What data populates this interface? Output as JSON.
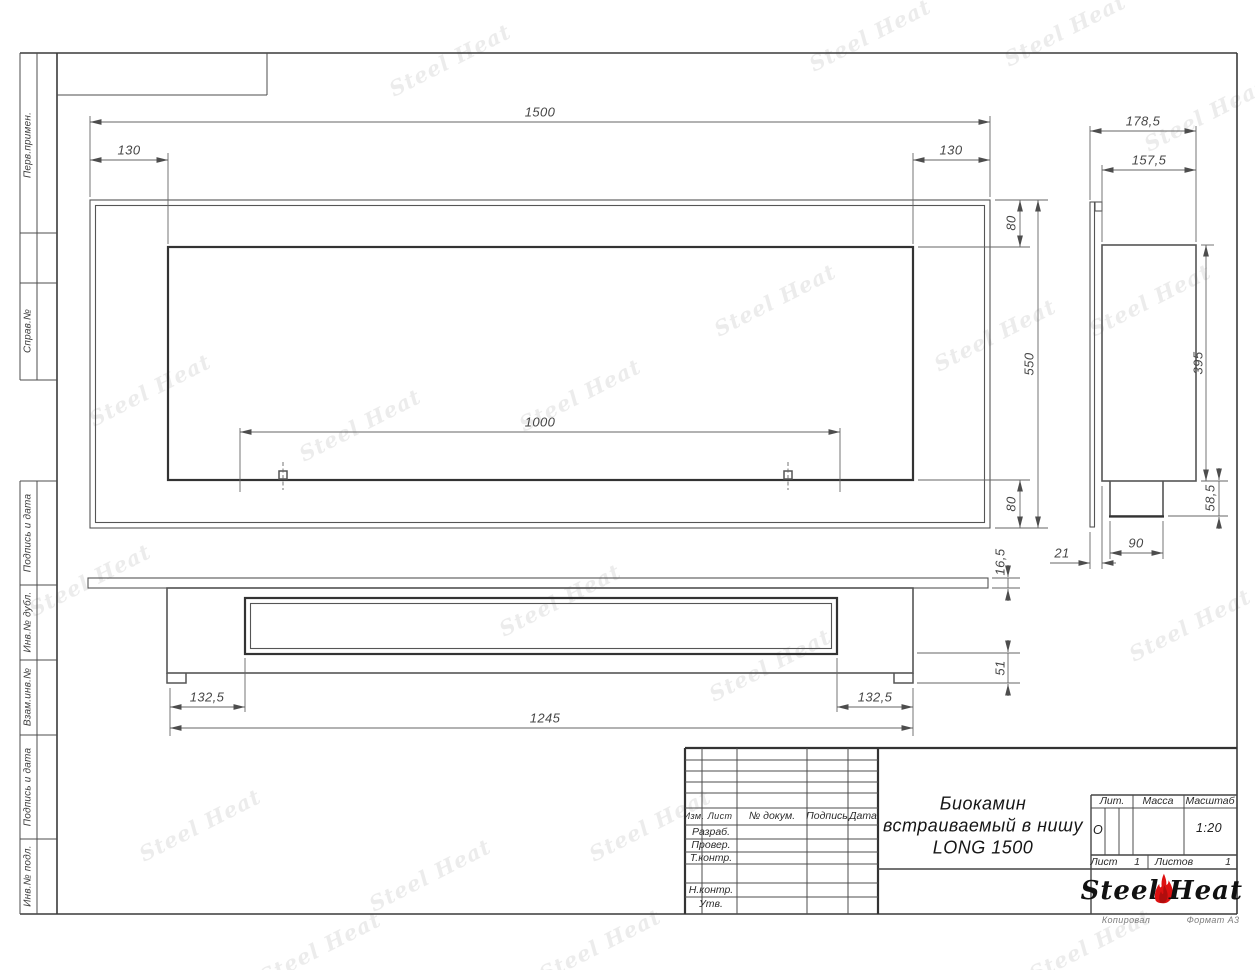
{
  "margins": {
    "items": [
      "Перв.примен.",
      "Справ.№",
      "Подпись и дата",
      "Инв.№ дубл.",
      "Взам.инв.№",
      "Подпись и дата",
      "Инв.№ подл."
    ]
  },
  "dims": {
    "front": {
      "total_width": "1500",
      "left_offset": "130",
      "right_offset": "130",
      "top_offset": "80",
      "height": "550",
      "bottom_offset": "80",
      "slot_width": "1000"
    },
    "side": {
      "total_depth": "178,5",
      "body_depth": "157,5",
      "body_height": "395",
      "tray_height": "58,5",
      "tray_width": "90",
      "flange_depth": "21"
    },
    "bottom": {
      "flange_thickness": "16,5",
      "body_thickness": "51",
      "left_offset": "132,5",
      "right_offset": "132,5",
      "body_width": "1245"
    }
  },
  "title_block": {
    "headers": {
      "izm": "Изм.",
      "list": "Лист",
      "doc": "№ докум.",
      "sign": "Подпись",
      "date": "Дата"
    },
    "roles": {
      "razrab": "Разраб.",
      "prover": "Провер.",
      "tkontr": "Т.контр.",
      "nkontr": "Н.контр.",
      "utv": "Утв."
    },
    "title_line1": "Биокамин",
    "title_line2": "встраиваемый в нишу",
    "title_line3": "LONG 1500",
    "lit_header": "Лит.",
    "mass_header": "Масса",
    "scale_header": "Масштаб",
    "lit_value": "О",
    "scale_value": "1:20",
    "sheet_label": "Лист",
    "sheet_value": "1",
    "sheets_label": "Листов",
    "sheets_value": "1",
    "logo_steel": "Steel",
    "logo_heat": "Heat"
  },
  "footer": {
    "copied": "Копировал",
    "format": "Формат A3"
  },
  "watermark": {
    "text": "Steel Heat"
  },
  "colors": {
    "flame_red": "#dd1111",
    "line_dark": "#3a3a3a"
  }
}
